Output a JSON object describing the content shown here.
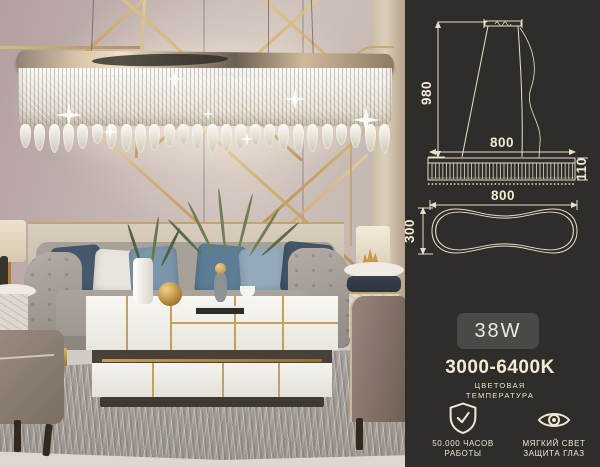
{
  "panel": {
    "background": "#2f2d2a",
    "text_color": "#f2e9d4",
    "side_view": {
      "height_mm": "980",
      "width_mm": "800",
      "body_height_mm": "110"
    },
    "top_view": {
      "width_mm": "800",
      "depth_mm": "300"
    },
    "power_badge": {
      "label": "38W",
      "background": "#4b4845"
    },
    "color_temperature": {
      "value": "3000-6400K",
      "caption_line1": "ЦВЕТОВАЯ",
      "caption_line2": "ТЕМПЕРАТУРА"
    },
    "features": [
      {
        "icon": "shield-check-icon",
        "caption_line1": "50.000 ЧАСОВ",
        "caption_line2": "РАБОТЫ"
      },
      {
        "icon": "eye-icon",
        "caption_line1": "МЯГКИЙ СВЕТ",
        "caption_line2": "ЗАЩИТА ГЛАЗ"
      }
    ]
  },
  "photo": {
    "colors": {
      "wall": "#c2b2ae",
      "gold_trim": "#c7a055",
      "sofa": "#a49d96",
      "pillows": [
        "#46586b",
        "#e9e5dd",
        "#7b95aa",
        "#5d7d96",
        "#93aabc",
        "#435669"
      ],
      "coffee_table": "#f4f1ec",
      "rug": "#a29b94",
      "floor": "#dcd6ce",
      "chandelier_crystal": "#f1ece1"
    }
  }
}
